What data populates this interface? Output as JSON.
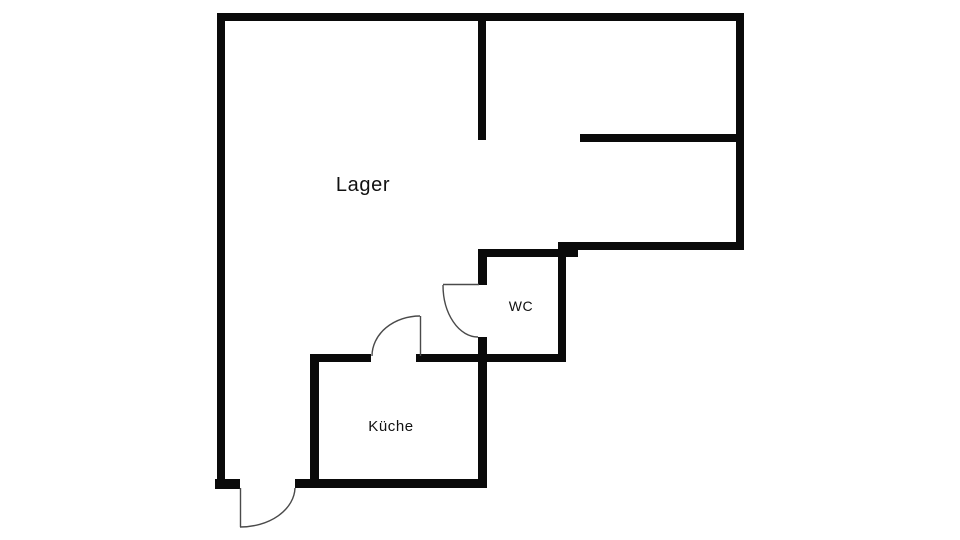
{
  "floorplan": {
    "title": "Floor plan",
    "background_color": "#ffffff",
    "wall_color": "#0a0a0a",
    "door_arc_color": "#4a4a4a",
    "label_color": "#111111",
    "rooms": [
      {
        "id": "lager",
        "label": "Lager"
      },
      {
        "id": "wc",
        "label": "WC"
      },
      {
        "id": "kueche",
        "label": "Küche"
      }
    ],
    "doors": [
      {
        "id": "wc-door",
        "type": "swing-door"
      },
      {
        "id": "kitchen-door",
        "type": "swing-door"
      },
      {
        "id": "entrance-door",
        "type": "swing-door"
      }
    ]
  }
}
